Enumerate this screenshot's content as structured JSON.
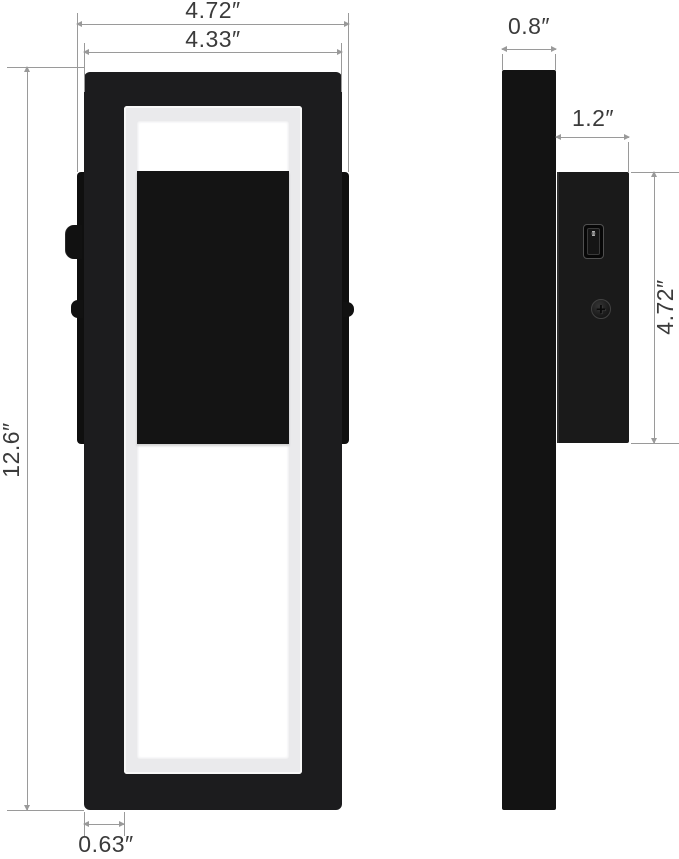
{
  "front_view": {
    "overall_width": "4.72″",
    "frame_width": "4.33″",
    "height": "12.6″",
    "frame_thickness": "0.63″"
  },
  "side_view": {
    "frame_depth": "0.8″",
    "body_depth": "1.2″",
    "body_height": "4.72″",
    "switch_on_mark": "I",
    "switch_off_mark": "O"
  },
  "icons": {
    "screw_phillips": "+"
  },
  "colors": {
    "background": "#ffffff",
    "fixture_black": "#1c1c1e",
    "panel_black": "#141414",
    "led_ring": "#eaeaec",
    "led_glow": "#ffffff",
    "dimension_line": "#9a9a9a",
    "dimension_text": "#3b3b3b"
  }
}
